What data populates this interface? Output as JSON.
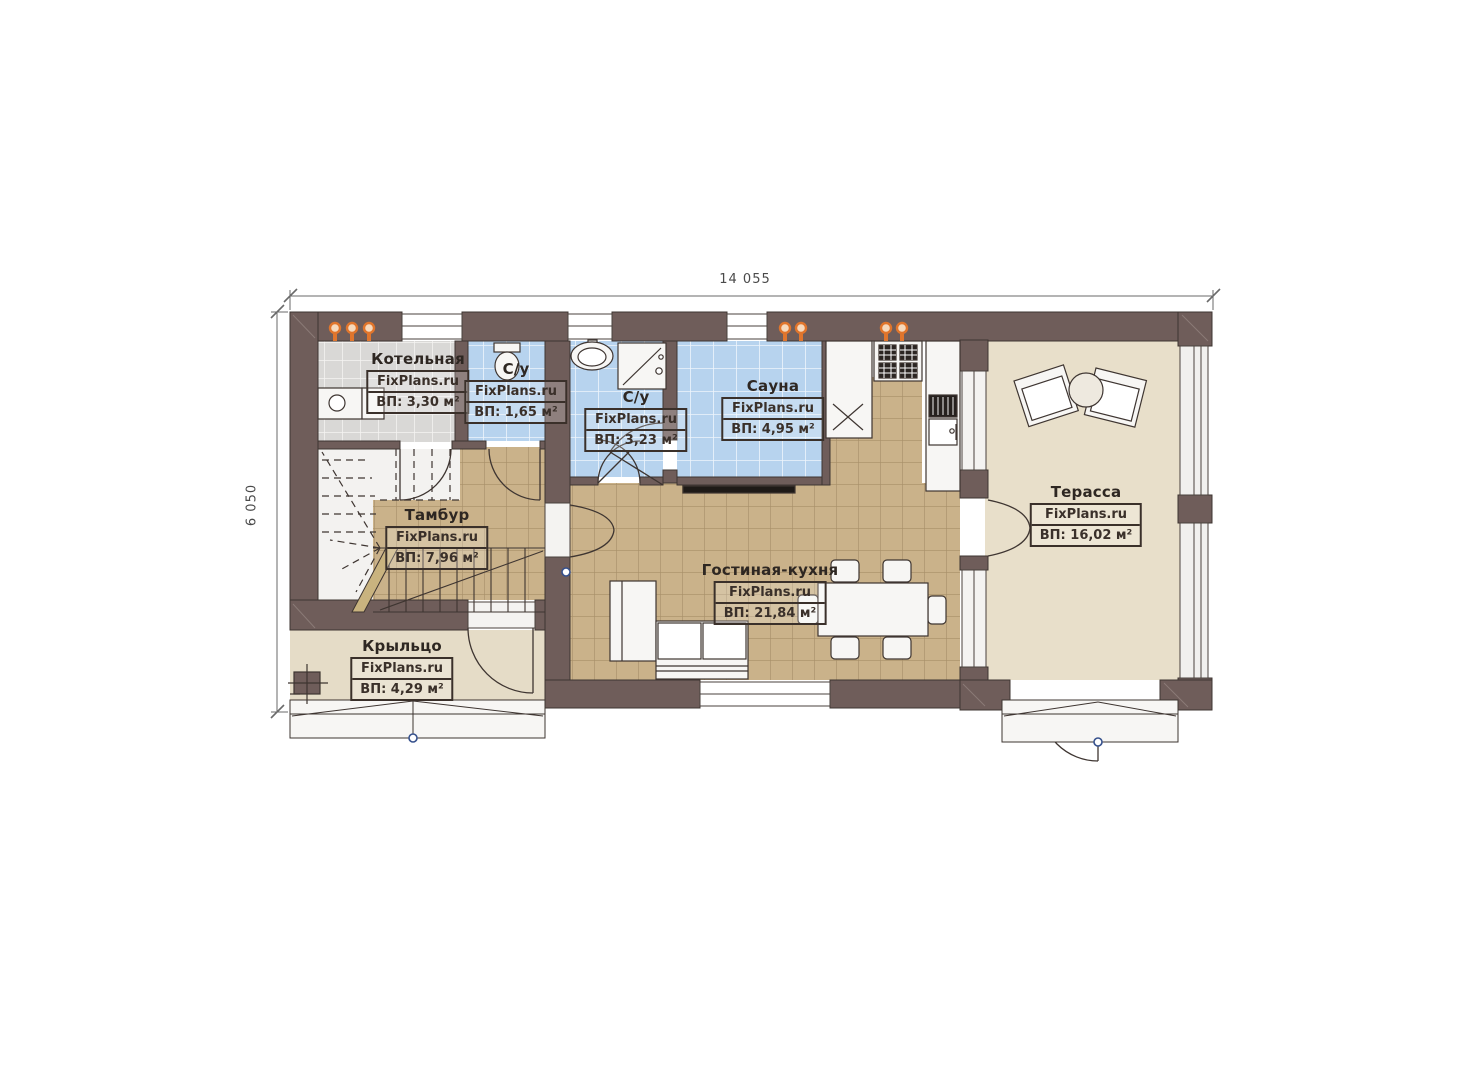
{
  "plan": {
    "dimensions": {
      "width_label": "14 055",
      "height_label": "6 050"
    },
    "rooms": [
      {
        "name": "Котельная",
        "watermark": "FixPlans.ru",
        "area": "ВП: 3,30 м²"
      },
      {
        "name": "С/у",
        "watermark": "FixPlans.ru",
        "area": "ВП: 1,65 м²"
      },
      {
        "name": "С/у",
        "watermark": "FixPlans.ru",
        "area": "ВП: 3,23 м²"
      },
      {
        "name": "Сауна",
        "watermark": "FixPlans.ru",
        "area": "ВП: 4,95 м²"
      },
      {
        "name": "Тамбур",
        "watermark": "FixPlans.ru",
        "area": "ВП: 7,96 м²"
      },
      {
        "name": "Гостиная-кухня",
        "watermark": "FixPlans.ru",
        "area": "ВП: 21,84 м²"
      },
      {
        "name": "Терасса",
        "watermark": "FixPlans.ru",
        "area": "ВП: 16,02 м²"
      },
      {
        "name": "Крыльцо",
        "watermark": "FixPlans.ru",
        "area": "ВП: 4,29 м²"
      }
    ],
    "colors": {
      "wall": "#6f5d5a",
      "tile_tan": "#cab28a",
      "tile_blue": "#b7d3ee",
      "tile_gray": "#d9d8d6",
      "terrace_floor": "#e8dfca",
      "porch_floor": "#e5dcc7",
      "accent_orange": "#e0752c"
    }
  }
}
